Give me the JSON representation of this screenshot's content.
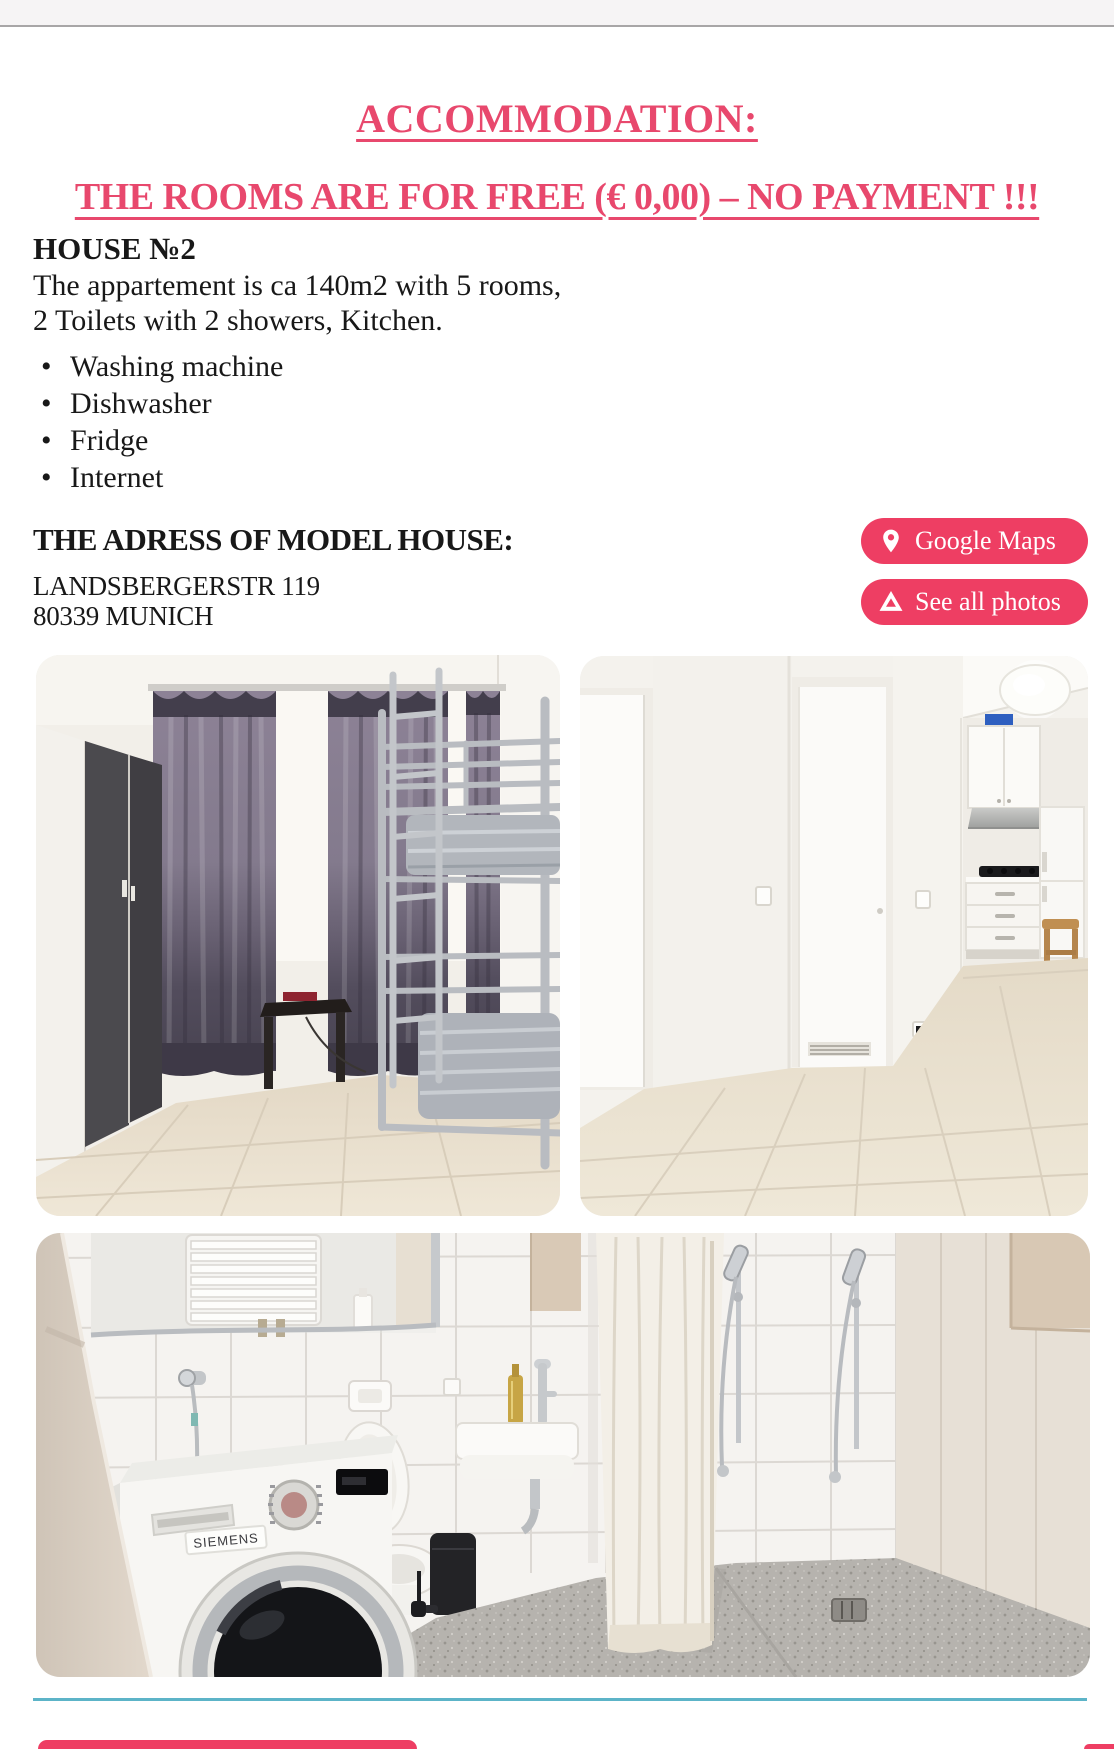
{
  "header": {
    "title": "ACCOMMODATION:",
    "subtitle": "THE ROOMS ARE FOR FREE (€ 0,00) – NO PAYMENT !!!"
  },
  "house": {
    "heading": "HOUSE №2",
    "description_line1": "The appartement is ca 140m2 with 5 rooms,",
    "description_line2": "2 Toilets with 2 showers, Kitchen.",
    "amenities": [
      "Washing machine",
      "Dishwasher",
      "Fridge",
      "Internet"
    ]
  },
  "address": {
    "heading": "THE ADRESS OF MODEL HOUSE:",
    "line1": "LANDSBERGERSTR 119",
    "line2": "80339 MUNICH"
  },
  "buttons": {
    "google_maps": {
      "label": "Google Maps",
      "icon": "location-pin-icon"
    },
    "see_all_photos": {
      "label": "See all photos",
      "icon": "google-drive-icon"
    }
  },
  "photos": [
    {
      "name": "bedroom-photo",
      "alt": "Bedroom with wardrobe, dark curtains and silver metal bunk bed"
    },
    {
      "name": "hallway-kitchen-photo",
      "alt": "White hallway with doors and small fitted kitchen"
    },
    {
      "name": "bathroom-photo",
      "alt": "Tiled bathroom with Siemens washing machine, toilet, sink and showers",
      "brand_label": "SIEMENS"
    }
  ],
  "colors": {
    "accent_text": "#e8486d",
    "button_pink": "#ee3e63",
    "divider_teal": "#5cb4c8",
    "topbar_gray": "#f6f4f5"
  }
}
